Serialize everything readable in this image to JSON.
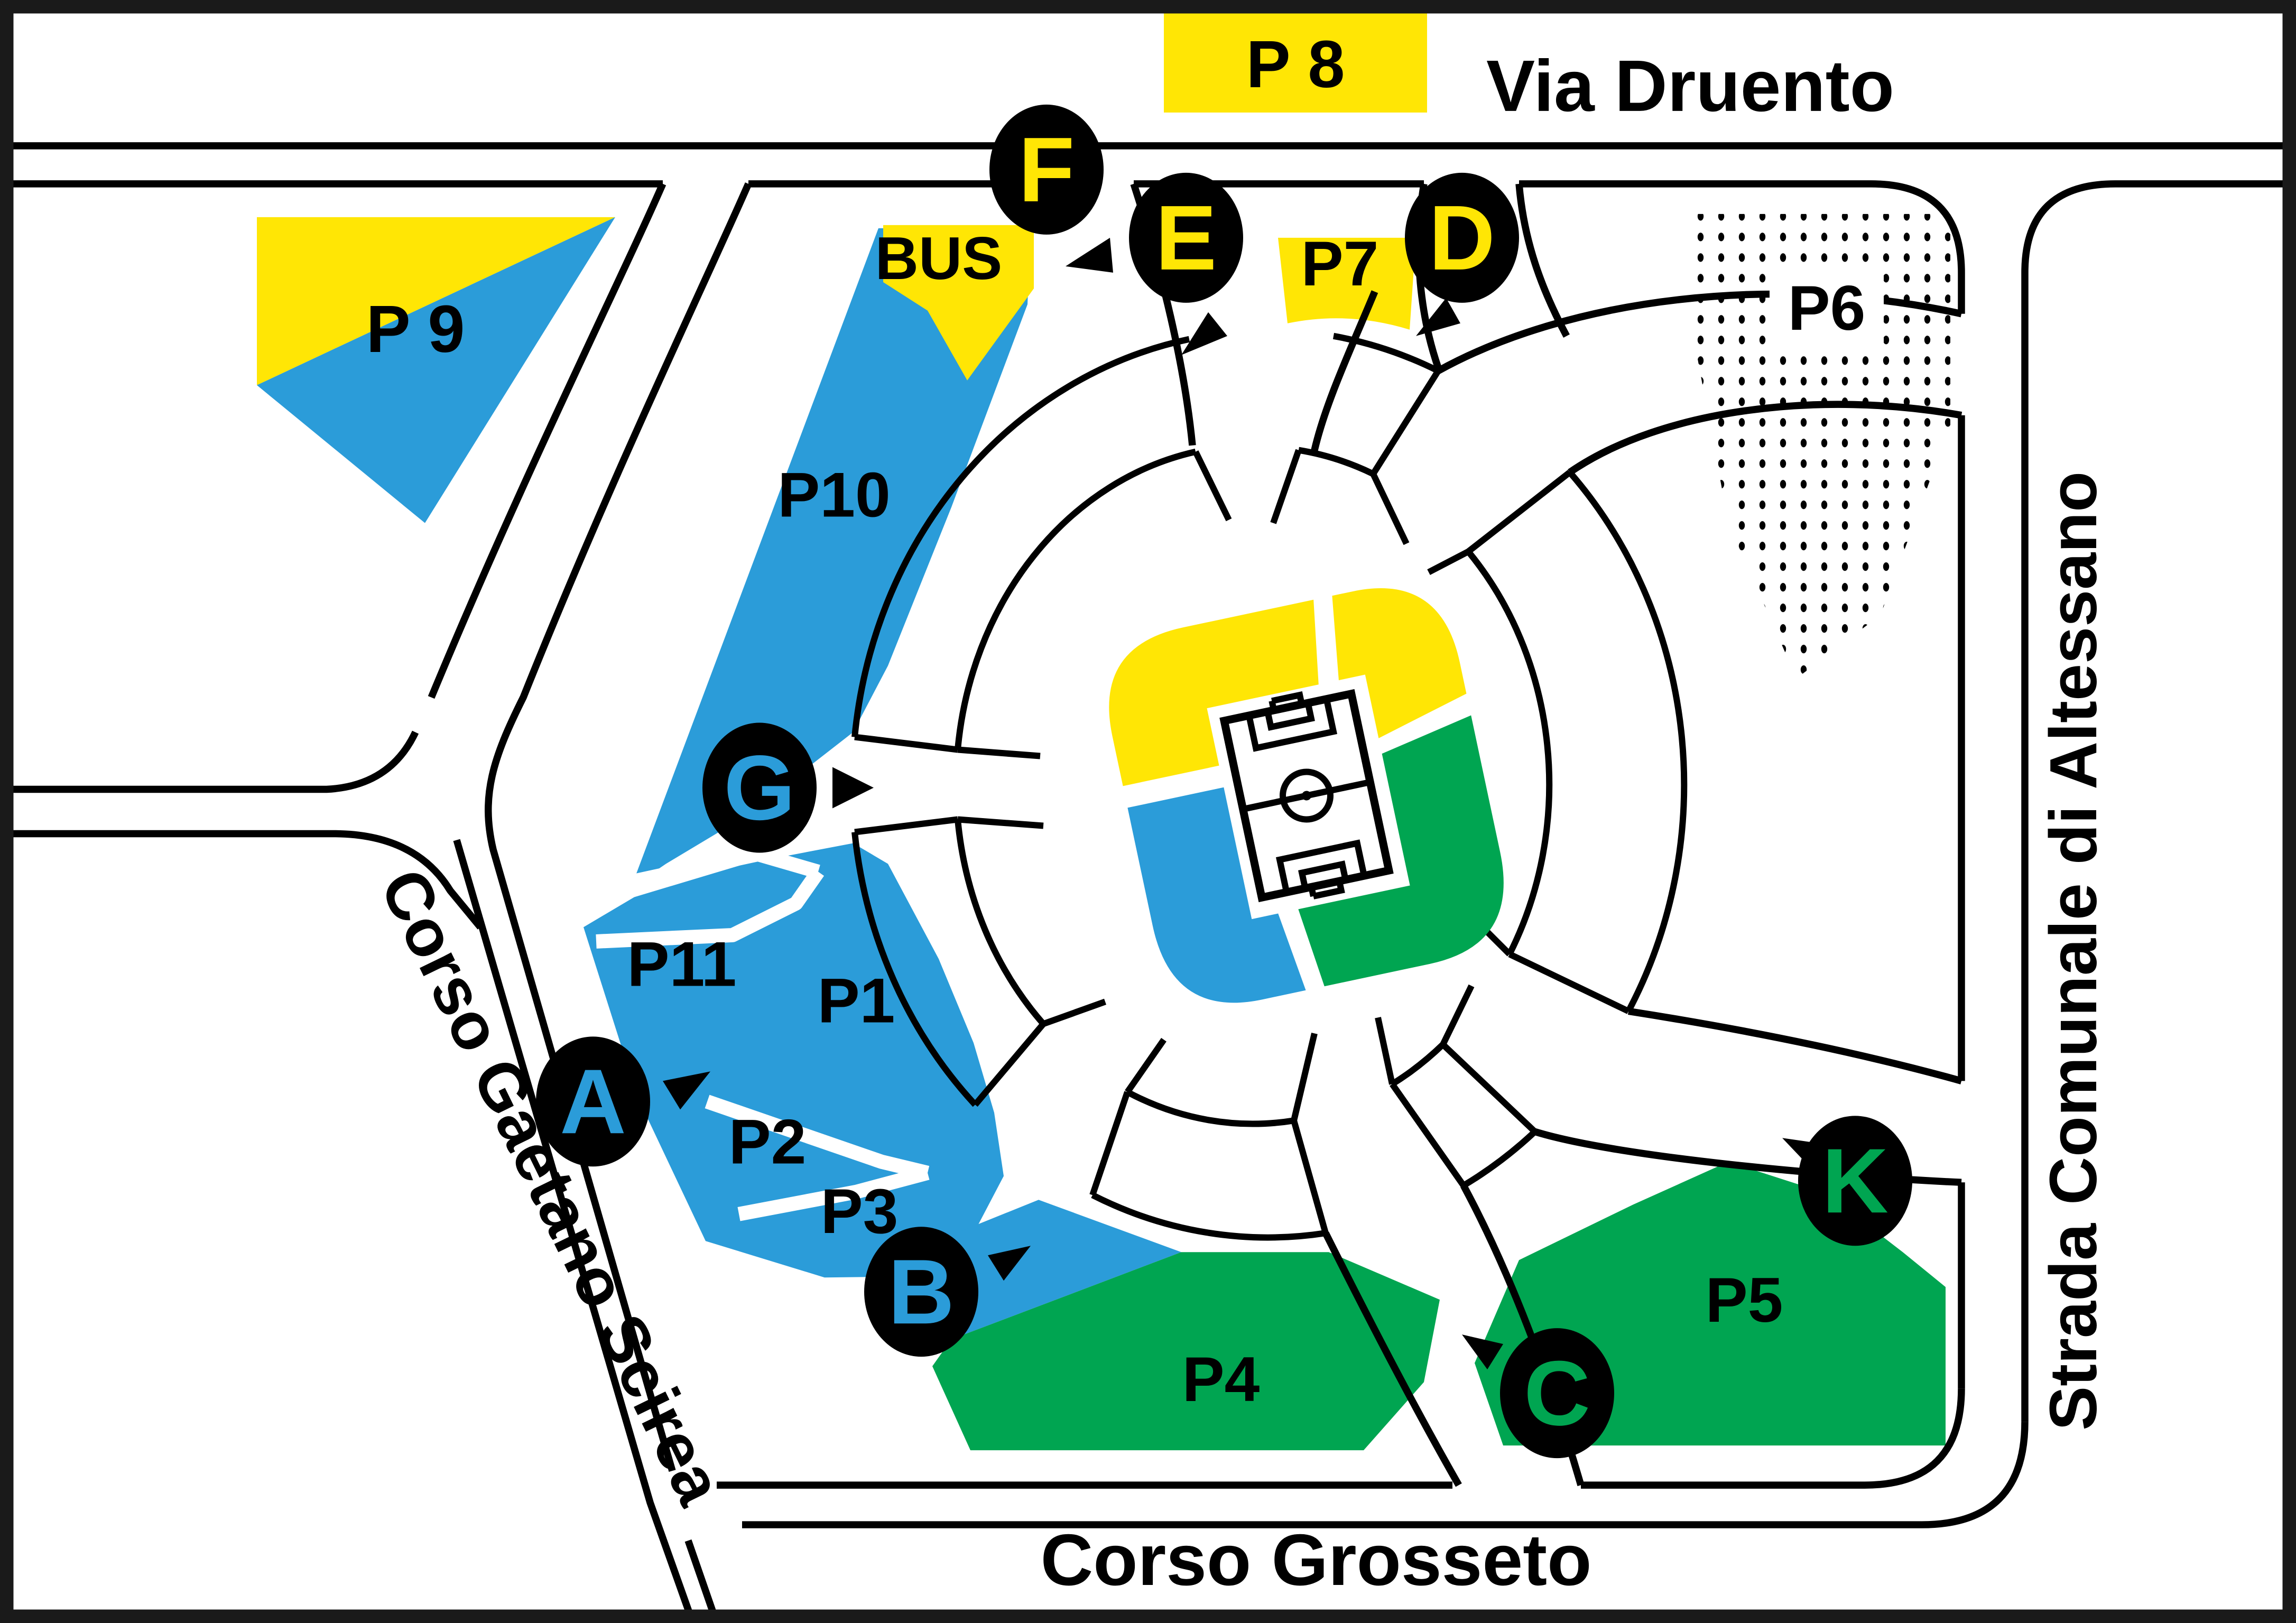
{
  "map": {
    "streets": {
      "top": "Via Druento",
      "left": "Corso Gaetano Scirea",
      "bottom": "Corso Grosseto",
      "right": "Strada Comunale di Altessano"
    },
    "parking_labels": {
      "p1": "P1",
      "p2": "P2",
      "p3": "P3",
      "p4": "P4",
      "p5": "P5",
      "p6": "P6",
      "p7": "P7",
      "p8": "P 8",
      "p9": "P 9",
      "p10": "P10",
      "p11": "P11",
      "bus": "BUS"
    },
    "gates": {
      "a": "A",
      "b": "B",
      "c": "C",
      "d": "D",
      "e": "E",
      "f": "F",
      "g": "G",
      "k": "K"
    },
    "gate_letter_colors": {
      "a": "#2B9CD9",
      "b": "#2B9CD9",
      "g": "#2B9CD9",
      "d": "#FFE605",
      "e": "#FFE605",
      "f": "#FFE605",
      "c": "#00A551",
      "k": "#00A551"
    },
    "colors": {
      "blue": "#2B9CD9",
      "yellow": "#FFE605",
      "green": "#00A551",
      "line": "#000000",
      "background": "#FFFFFF"
    }
  }
}
